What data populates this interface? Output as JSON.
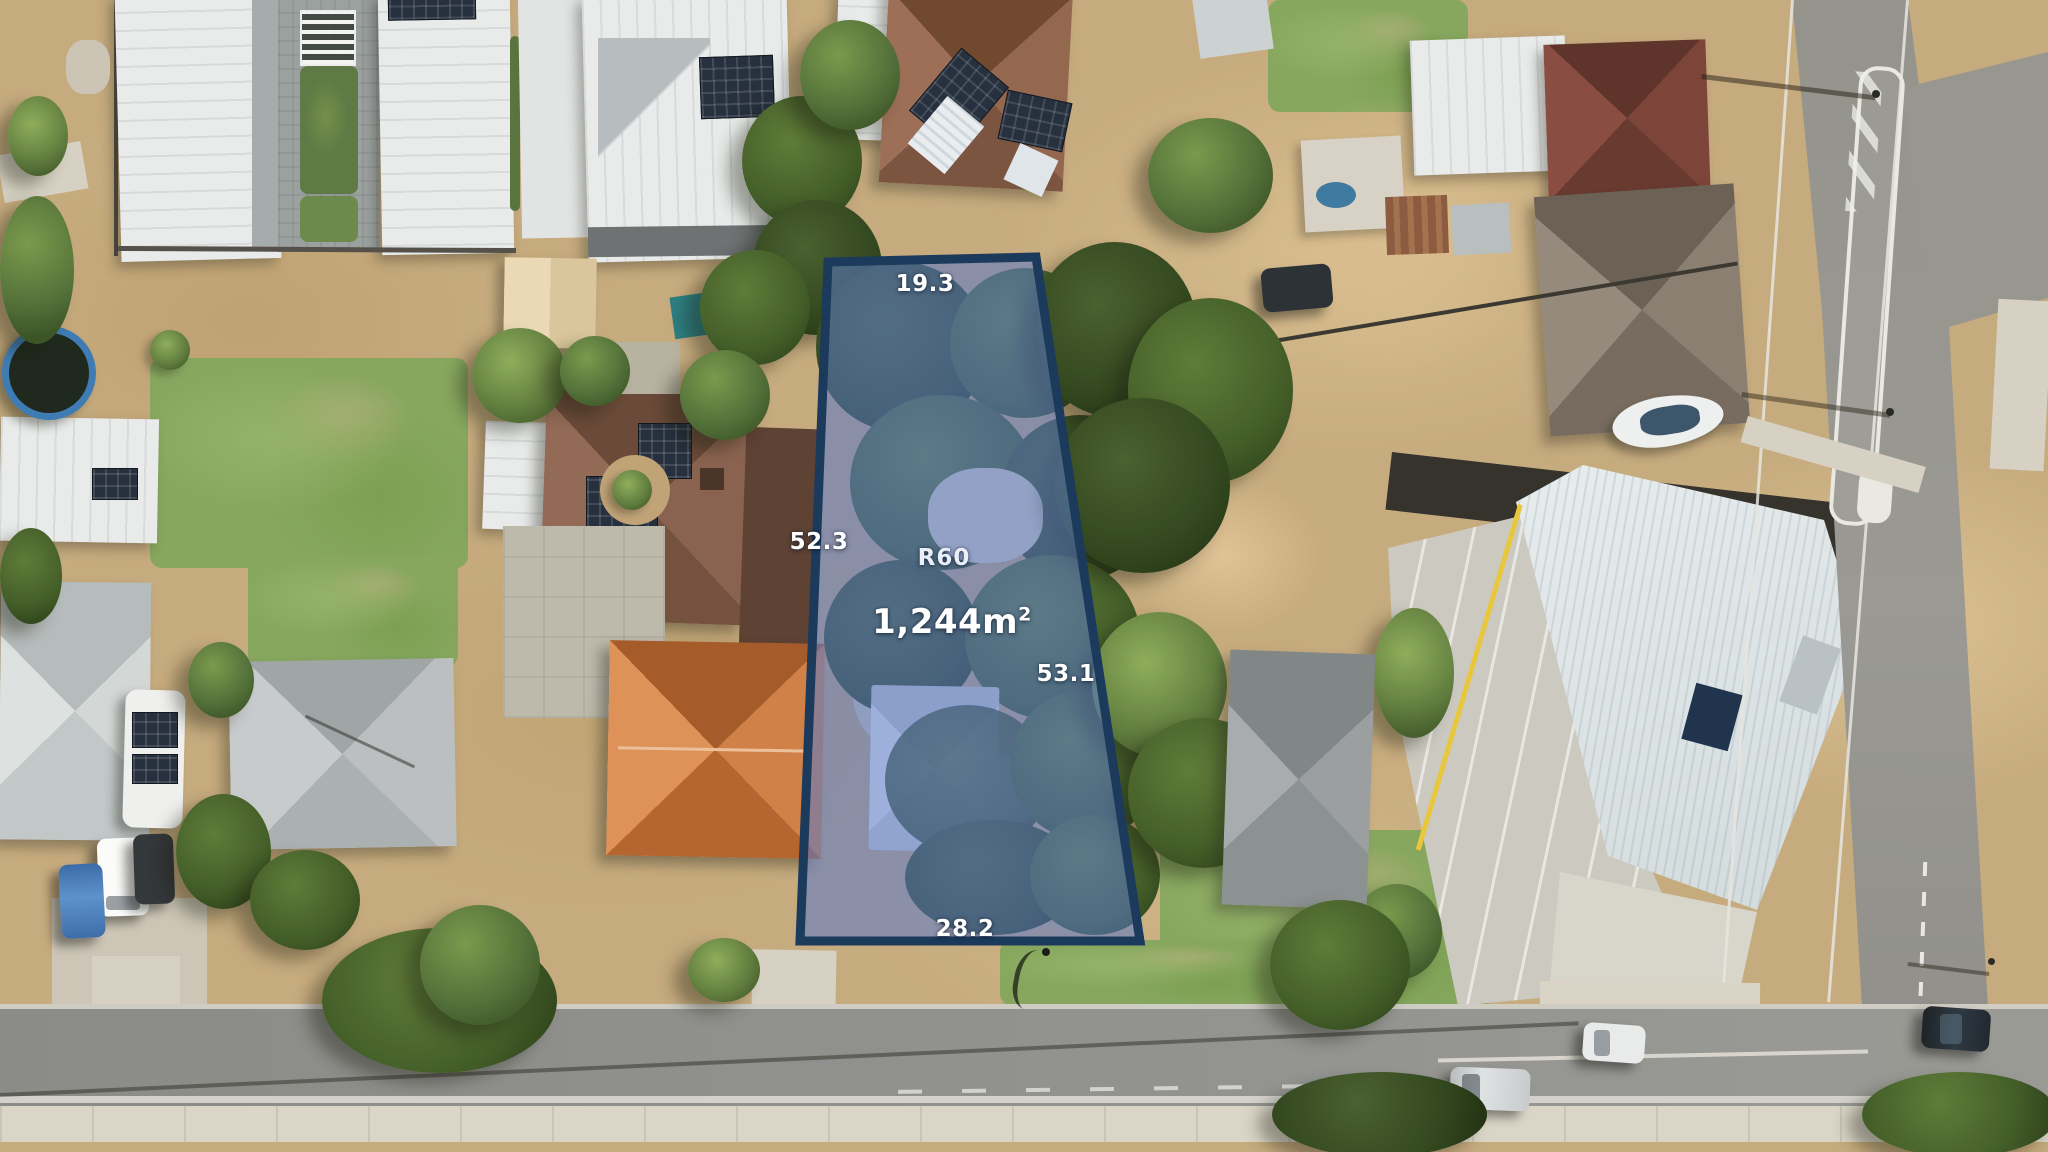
{
  "scene": {
    "description": "Aerial drone photo of suburban block with highlighted development lot",
    "lot": {
      "zoning": "R60",
      "area": "1,244m",
      "area_sup": "2",
      "dim_top": "19.3",
      "dim_left": "52.3",
      "dim_right": "53.1",
      "dim_bottom": "28.2"
    },
    "colors": {
      "lot_fill": "#5a78c8",
      "lot_border": "#1b3a5c",
      "label_text": "#ffffff"
    }
  }
}
